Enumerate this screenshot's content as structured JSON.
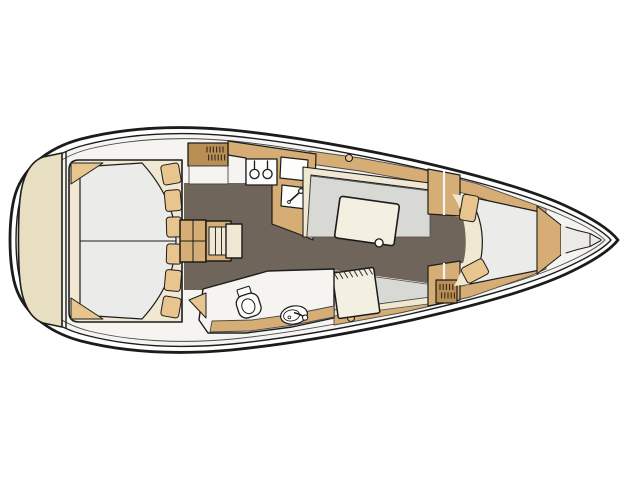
{
  "diagram": {
    "kind": "boat-floor-plan",
    "description": "Top-view interior layout plan of a sailing yacht, bow pointing right",
    "orientation": {
      "bow": "right",
      "stern": "left"
    },
    "areas": [
      {
        "id": "aft-cabin",
        "name": "aft double berth",
        "features": [
          "mattress split in two",
          "six pillows",
          "two corner shelves",
          "transom seat pad"
        ]
      },
      {
        "id": "companionway",
        "name": "companionway steps",
        "features": [
          "landing platform",
          "three treads"
        ]
      },
      {
        "id": "galley",
        "name": "galley",
        "features": [
          "hanging locker",
          "two-burner stove",
          "worktop",
          "sink with faucet"
        ]
      },
      {
        "id": "head",
        "name": "head compartment",
        "features": [
          "marine toilet",
          "washbasin with faucet",
          "hull shelf"
        ]
      },
      {
        "id": "salon",
        "name": "salon",
        "features": [
          "port settee",
          "dining table with leg",
          "starboard settee",
          "chart table"
        ]
      },
      {
        "id": "midship",
        "name": "midship lockers",
        "features": [
          "bulkhead cabinets",
          "hatched wardrobe locker"
        ]
      },
      {
        "id": "forward-cabin",
        "name": "forward V-berth",
        "features": [
          "v-berth mattress",
          "two pillows",
          "bow shelf"
        ]
      },
      {
        "id": "forepeak",
        "name": "anchor locker"
      }
    ],
    "deck_fittings": [
      "port deck ring",
      "starboard deck ring"
    ]
  },
  "colors": {
    "page": "#ffffff",
    "line": "#1c1c1c",
    "lineSoft": "#4a4a4a",
    "deck": "#f5f4f0",
    "floor": "#6f655b",
    "wood": "#d6ae75",
    "woodDark": "#b98f55",
    "woodLight": "#e8c48e",
    "cream": "#f0e8d2",
    "pad": "#e8dfc2",
    "mattress": "#ebebe9",
    "cushion": "#d8d8d5",
    "fixture": "#fdfdfb",
    "tableTop": "#f3f0e2",
    "forepeak": "#eceae5"
  }
}
